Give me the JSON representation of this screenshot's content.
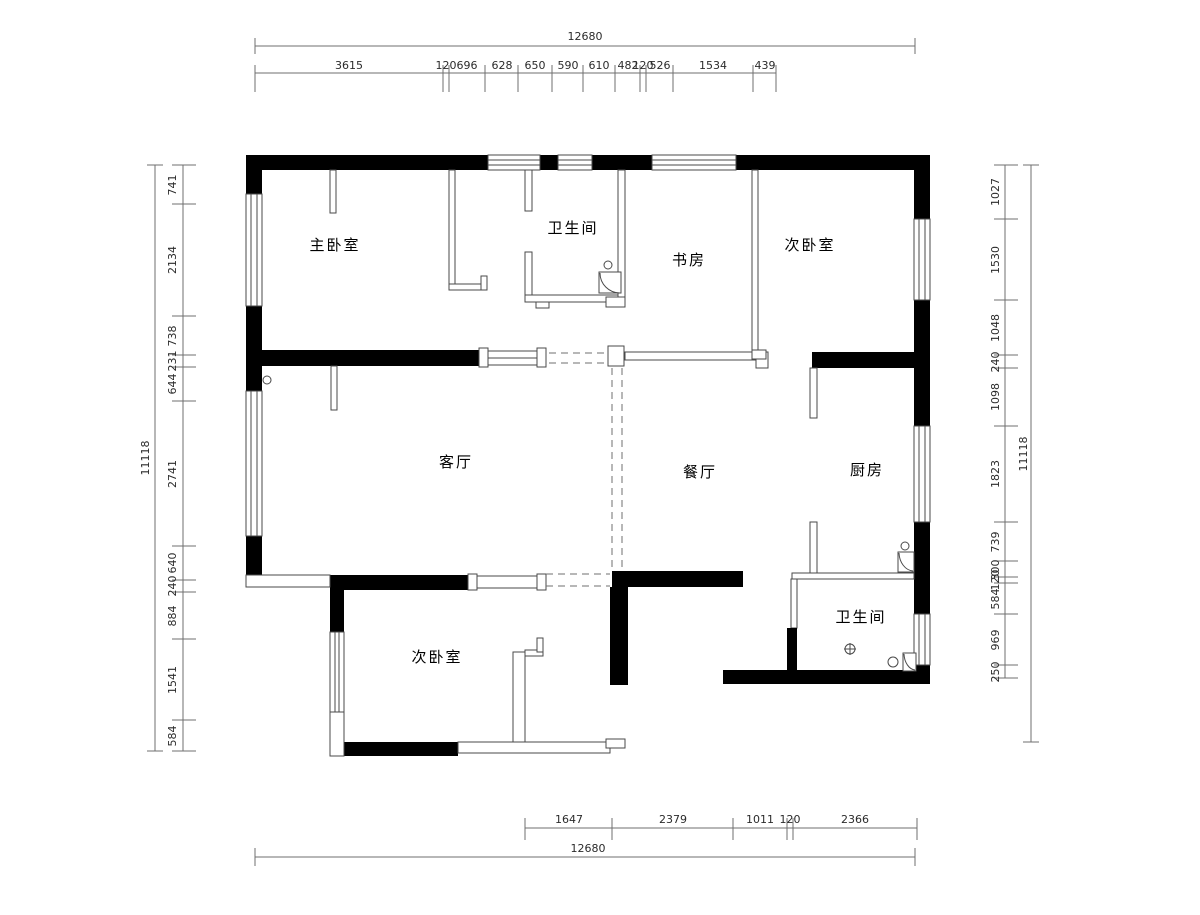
{
  "drawing": {
    "type": "floor-plan",
    "background": "#ffffff",
    "wall_color": "#000000",
    "thin_line_color": "#4a4a4a",
    "dimension_color": "#6f6f6f"
  },
  "rooms": [
    {
      "id": "master-bedroom",
      "label": "主卧室"
    },
    {
      "id": "bathroom-top",
      "label": "卫生间"
    },
    {
      "id": "study",
      "label": "书房"
    },
    {
      "id": "bedroom-top-right",
      "label": "次卧室"
    },
    {
      "id": "living-room",
      "label": "客厅"
    },
    {
      "id": "dining-room",
      "label": "餐厅"
    },
    {
      "id": "kitchen",
      "label": "厨房"
    },
    {
      "id": "bathroom-bottom",
      "label": "卫生间"
    },
    {
      "id": "bedroom-bottom-left",
      "label": "次卧室"
    }
  ],
  "dims": {
    "top_total": "12680",
    "top_chain": [
      "3615",
      "120",
      "696",
      "628",
      "650",
      "590",
      "610",
      "482",
      "120",
      "526",
      "1534",
      "439"
    ],
    "bottom_chain": [
      "1647",
      "2379",
      "1011",
      "120",
      "2366"
    ],
    "bottom_total": "12680",
    "left_total": "11118",
    "left_chain": [
      "741",
      "2134",
      "738",
      "231",
      "644",
      "2741",
      "640",
      "240",
      "884",
      "1541",
      "584"
    ],
    "right_total": "11118",
    "right_chain": [
      "1027",
      "1530",
      "1048",
      "240",
      "1098",
      "1823",
      "739",
      "300",
      "120",
      "584",
      "969",
      "250"
    ]
  }
}
